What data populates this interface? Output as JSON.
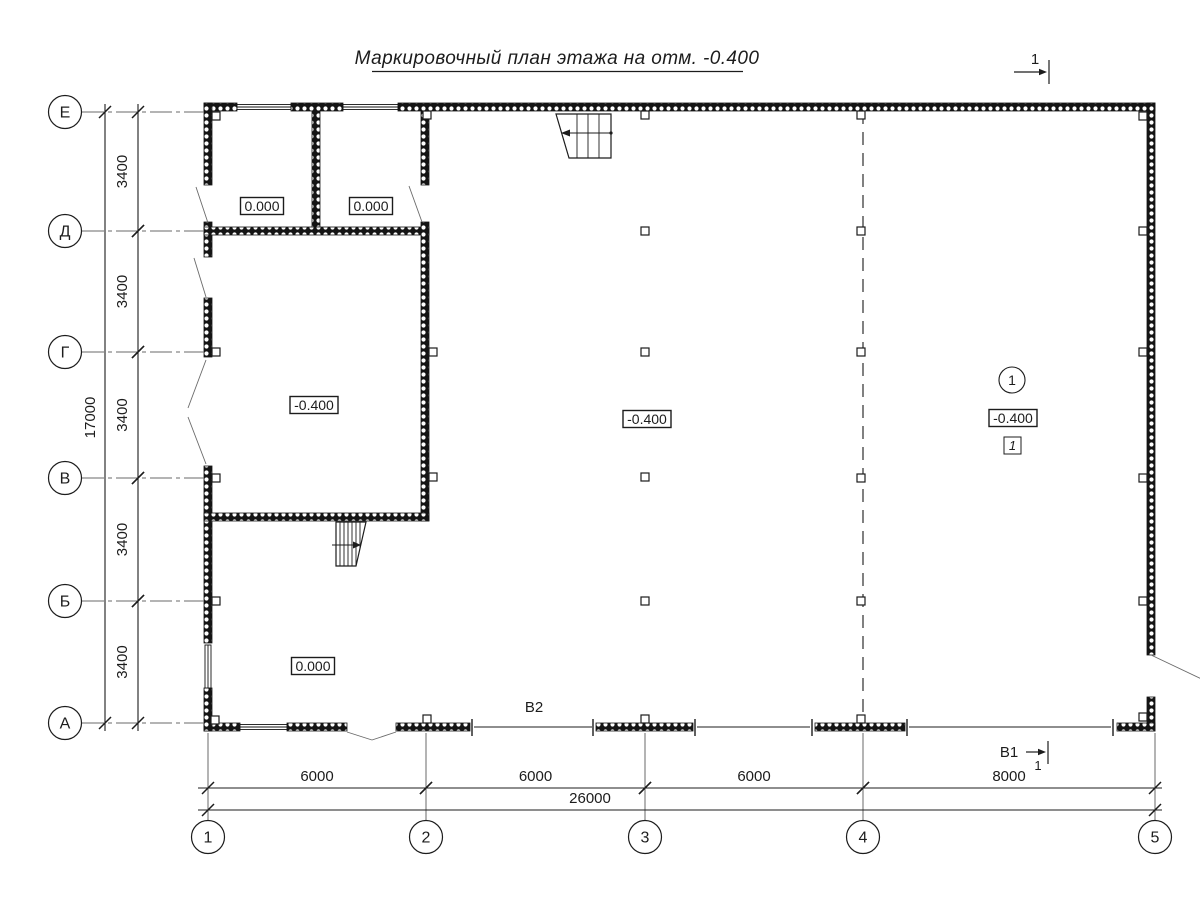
{
  "title": {
    "text": "Маркировочный план этажа на отм. -0.400"
  },
  "colors": {
    "ink": "#1c1c1c",
    "thin": "#6a6a6a",
    "bg": "#ffffff"
  },
  "axes": {
    "rows": [
      {
        "label": "Е",
        "y": 112
      },
      {
        "label": "Д",
        "y": 231
      },
      {
        "label": "Г",
        "y": 352
      },
      {
        "label": "В",
        "y": 478
      },
      {
        "label": "Б",
        "y": 601
      },
      {
        "label": "А",
        "y": 723
      }
    ],
    "cols": [
      {
        "label": "1",
        "x": 208
      },
      {
        "label": "2",
        "x": 426
      },
      {
        "label": "3",
        "x": 645
      },
      {
        "label": "4",
        "x": 863
      },
      {
        "label": "5",
        "x": 1155
      }
    ]
  },
  "dims": {
    "left": {
      "segments": [
        {
          "label": "3400",
          "a": 112,
          "b": 231
        },
        {
          "label": "3400",
          "a": 231,
          "b": 352
        },
        {
          "label": "3400",
          "a": 352,
          "b": 478
        },
        {
          "label": "3400",
          "a": 478,
          "b": 601
        },
        {
          "label": "3400",
          "a": 601,
          "b": 723
        }
      ],
      "total": {
        "label": "17000",
        "a": 112,
        "b": 723
      }
    },
    "bottom": {
      "segments": [
        {
          "label": "6000",
          "a": 208,
          "b": 426
        },
        {
          "label": "6000",
          "a": 426,
          "b": 645
        },
        {
          "label": "6000",
          "a": 645,
          "b": 863
        },
        {
          "label": "8000",
          "a": 863,
          "b": 1155
        }
      ],
      "total": {
        "label": "26000",
        "a": 208,
        "b": 1155,
        "lx": 590
      }
    }
  },
  "elevations": [
    {
      "label": "0.000",
      "x": 262,
      "y": 206
    },
    {
      "label": "0.000",
      "x": 371,
      "y": 206
    },
    {
      "label": "-0.400",
      "x": 314,
      "y": 405
    },
    {
      "label": "-0.400",
      "x": 647,
      "y": 419
    },
    {
      "label": "-0.400",
      "x": 1013,
      "y": 418
    },
    {
      "label": "0.000",
      "x": 313,
      "y": 666
    }
  ],
  "section_marks": {
    "top_right": {
      "label": "1"
    },
    "b1": {
      "label": "В1",
      "detail": "1"
    },
    "b2": {
      "label": "В2"
    }
  },
  "room_tag": {
    "number": "1",
    "type_mark": "1"
  },
  "plan": {
    "column_markers": [
      [
        645,
        231
      ],
      [
        645,
        352
      ],
      [
        645,
        477
      ],
      [
        645,
        601
      ],
      [
        861,
        115
      ],
      [
        861,
        231
      ],
      [
        861,
        352
      ],
      [
        861,
        478
      ],
      [
        861,
        601
      ],
      [
        861,
        719
      ],
      [
        1143,
        116
      ],
      [
        1143,
        231
      ],
      [
        1143,
        352
      ],
      [
        1143,
        478
      ],
      [
        1143,
        601
      ],
      [
        1143,
        717
      ],
      [
        216,
        116
      ],
      [
        216,
        352
      ],
      [
        216,
        478
      ],
      [
        216,
        601
      ],
      [
        215,
        720
      ],
      [
        427,
        115
      ],
      [
        433,
        352
      ],
      [
        433,
        477
      ],
      [
        427,
        719
      ],
      [
        645,
        115
      ],
      [
        645,
        719
      ]
    ]
  }
}
